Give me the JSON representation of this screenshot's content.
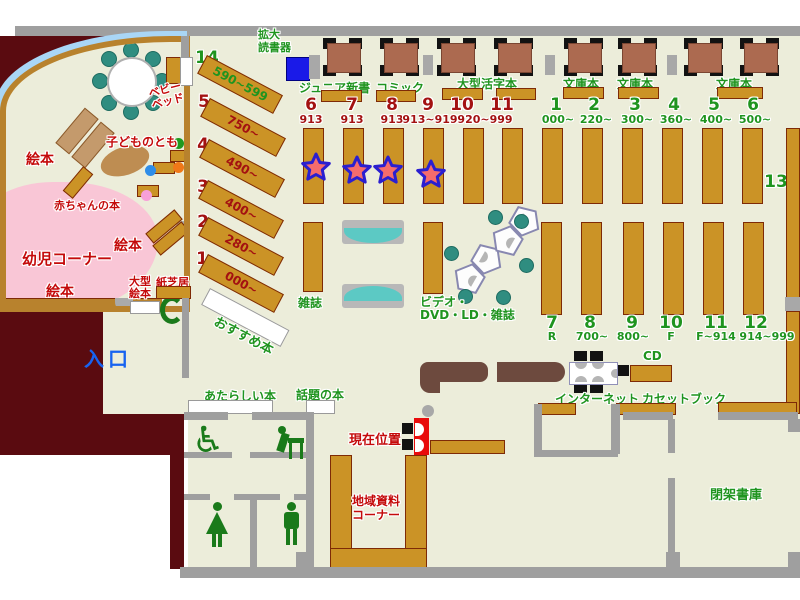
{
  "title": "library-floor-map",
  "colors": {
    "floor": "#ecedda",
    "wall_gray": "#9f9f9f",
    "outside_maroon": "#5a0b10",
    "shelf_gold": "#cb9326",
    "table_brown": "#ac6a50",
    "counter_brown": "#6d4a3e",
    "kids_pink": "#f9c6d6",
    "glass_blue": "#a9d6f6",
    "green_text": "#1f941f",
    "red_text": "#c40a0a",
    "dark_red_num": "#a31111",
    "entrance_blue": "#1763f0",
    "reader_blue": "#1a1ae8",
    "star_red": "#f56c6c",
    "star_blue": "#2a1fd0",
    "bench_teal": "#5cc9c4"
  },
  "top": {
    "reader_line1": "拡大",
    "reader_line2": "読書器",
    "junior": "ジュニア新書",
    "comic": "コミック",
    "large_print": "大型活字本",
    "bunko1": "文庫本",
    "bunko2": "文庫本",
    "bunko3": "文庫本"
  },
  "row1_red": [
    {
      "num": "6",
      "sub": "913"
    },
    {
      "num": "7",
      "sub": "913"
    },
    {
      "num": "8",
      "sub": "913"
    },
    {
      "num": "9",
      "sub": "913~919"
    },
    {
      "num": "10",
      "sub": ""
    },
    {
      "num": "11",
      "sub": ""
    }
  ],
  "row1_red_shared_sub": "920~999",
  "row1_green": [
    {
      "num": "1",
      "sub": "000~"
    },
    {
      "num": "2",
      "sub": "220~"
    },
    {
      "num": "3",
      "sub": "300~"
    },
    {
      "num": "4",
      "sub": "360~"
    },
    {
      "num": "5",
      "sub": "400~"
    },
    {
      "num": "6",
      "sub": "500~"
    }
  ],
  "shelf13": "13",
  "row2": [
    {
      "num": "7",
      "sub": "R"
    },
    {
      "num": "8",
      "sub": "700~"
    },
    {
      "num": "9",
      "sub": "800~"
    },
    {
      "num": "10",
      "sub": "F"
    },
    {
      "num": "11",
      "sub": "F~914"
    },
    {
      "num": "12",
      "sub": "914~999"
    }
  ],
  "diagonal": [
    {
      "num": "14",
      "range": "590~599"
    },
    {
      "num": "5",
      "range": "750~"
    },
    {
      "num": "4",
      "range": "490~"
    },
    {
      "num": "3",
      "range": "400~"
    },
    {
      "num": "2",
      "range": "280~"
    },
    {
      "num": "1",
      "range": "000~"
    }
  ],
  "kids": {
    "ehon_top": "絵本",
    "ehon_mid": "絵本",
    "ehon_bottom": "絵本",
    "yoji_corner": "幼児コーナー",
    "akachan": "赤ちゃんの本",
    "kodomo": "子どものとも",
    "baby_bed_line1": "ベビー",
    "baby_bed_line2": "ベッド",
    "ogata_line1": "大型",
    "ogata_line2": "絵本",
    "kamishibai": "紙芝居"
  },
  "center": {
    "zasshi": "雑誌",
    "video_line1": "ビデオ・",
    "video_line2": "DVD・LD・雑誌",
    "osusume": "おすすめ本"
  },
  "entrance_label": "入口",
  "bottom": {
    "atarashii": "あたらしい本",
    "wadai": "話題の本",
    "genzai": "現在位置",
    "chiiki_line1": "地域資料",
    "chiiki_line2": "コーナー",
    "internet": "インターネット",
    "cassette": "カセットブック",
    "cd": "CD",
    "heika": "閉架書庫"
  }
}
